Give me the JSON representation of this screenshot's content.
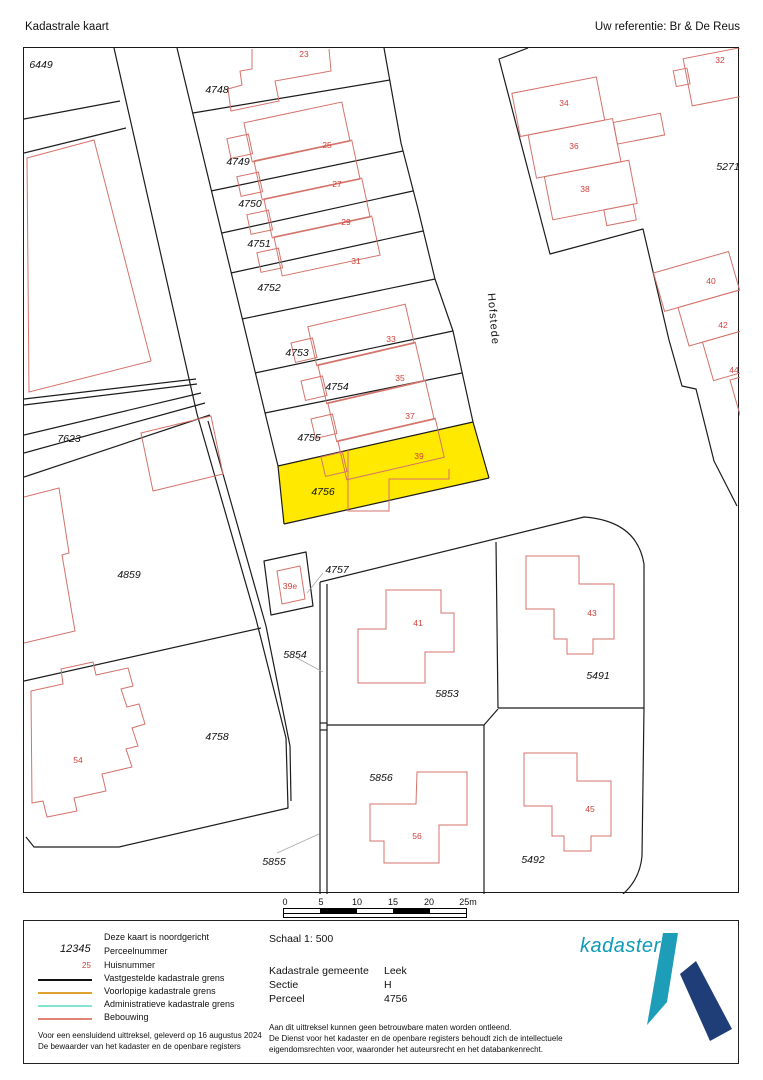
{
  "header": {
    "title": "Kadastrale kaart",
    "reference": "Uw referentie: Br & De Reus"
  },
  "map": {
    "street_label": "Hofstede",
    "highlight_color": "#ffe900",
    "highlighted_parcel": "4756",
    "parcel_labels": [
      {
        "text": "6449",
        "x": 40,
        "y": 67
      },
      {
        "text": "4748",
        "x": 216,
        "y": 92
      },
      {
        "text": "4749",
        "x": 237,
        "y": 164
      },
      {
        "text": "4750",
        "x": 249,
        "y": 206
      },
      {
        "text": "4751",
        "x": 258,
        "y": 246
      },
      {
        "text": "4752",
        "x": 268,
        "y": 290
      },
      {
        "text": "4753",
        "x": 296,
        "y": 355
      },
      {
        "text": "4754",
        "x": 336,
        "y": 389
      },
      {
        "text": "4755",
        "x": 308,
        "y": 440
      },
      {
        "text": "4756",
        "x": 322,
        "y": 494
      },
      {
        "text": "7623",
        "x": 68,
        "y": 441
      },
      {
        "text": "4859",
        "x": 128,
        "y": 577
      },
      {
        "text": "4758",
        "x": 216,
        "y": 739
      },
      {
        "text": "5271",
        "x": 727,
        "y": 169
      },
      {
        "text": "5853",
        "x": 446,
        "y": 696
      },
      {
        "text": "5491",
        "x": 597,
        "y": 678
      },
      {
        "text": "5492",
        "x": 532,
        "y": 862
      },
      {
        "text": "5856",
        "x": 380,
        "y": 780
      },
      {
        "text": "4757",
        "x": 336,
        "y": 572
      },
      {
        "text": "5854",
        "x": 294,
        "y": 657
      },
      {
        "text": "5855",
        "x": 273,
        "y": 864
      }
    ],
    "house_labels": [
      {
        "text": "23",
        "x": 303,
        "y": 56
      },
      {
        "text": "25",
        "x": 326,
        "y": 147
      },
      {
        "text": "27",
        "x": 336,
        "y": 186
      },
      {
        "text": "29",
        "x": 345,
        "y": 224
      },
      {
        "text": "31",
        "x": 355,
        "y": 263
      },
      {
        "text": "33",
        "x": 390,
        "y": 341
      },
      {
        "text": "35",
        "x": 399,
        "y": 380
      },
      {
        "text": "37",
        "x": 409,
        "y": 418
      },
      {
        "text": "39",
        "x": 418,
        "y": 458
      },
      {
        "text": "39e",
        "x": 289,
        "y": 588
      },
      {
        "text": "32",
        "x": 719,
        "y": 62
      },
      {
        "text": "34",
        "x": 563,
        "y": 105
      },
      {
        "text": "36",
        "x": 573,
        "y": 148
      },
      {
        "text": "38",
        "x": 584,
        "y": 191
      },
      {
        "text": "40",
        "x": 710,
        "y": 283
      },
      {
        "text": "42",
        "x": 722,
        "y": 327
      },
      {
        "text": "44",
        "x": 733,
        "y": 372
      },
      {
        "text": "41",
        "x": 417,
        "y": 625
      },
      {
        "text": "43",
        "x": 591,
        "y": 615
      },
      {
        "text": "45",
        "x": 589,
        "y": 811
      },
      {
        "text": "54",
        "x": 77,
        "y": 762
      },
      {
        "text": "56",
        "x": 416,
        "y": 838
      }
    ]
  },
  "scalebar": {
    "ticks": [
      "0",
      "5",
      "10",
      "15",
      "20",
      "25m"
    ]
  },
  "legend": {
    "north_note": "Deze kaart is noordgericht",
    "items": [
      {
        "sample": "12345",
        "label": "Perceelnummer"
      },
      {
        "sample": "25",
        "label": "Huisnummer"
      },
      {
        "label": "Vastgestelde kadastrale grens"
      },
      {
        "label": "Voorlopige kadastrale grens"
      },
      {
        "label": "Administratieve kadastrale grens"
      },
      {
        "label": "Bebouwing"
      }
    ],
    "footer_line1": "Voor een eensluidend uittreksel, geleverd op 16 augustus 2024",
    "footer_line2": "De bewaarder van het kadaster en de openbare registers"
  },
  "info": {
    "scale_label": "Schaal 1: 500",
    "rows": [
      {
        "label": "Kadastrale gemeente",
        "value": "Leek"
      },
      {
        "label": "Sectie",
        "value": "H"
      },
      {
        "label": "Perceel",
        "value": "4756"
      }
    ],
    "disclaimer1": "Aan dit uittreksel kunnen geen betrouwbare maten worden ontleend.",
    "disclaimer2": "De Dienst voor het kadaster en de openbare registers behoudt zich de intellectuele",
    "disclaimer3": "eigendomsrechten voor, waaronder het auteursrecht en het databankenrecht."
  },
  "logo": {
    "text": "kadaster"
  }
}
